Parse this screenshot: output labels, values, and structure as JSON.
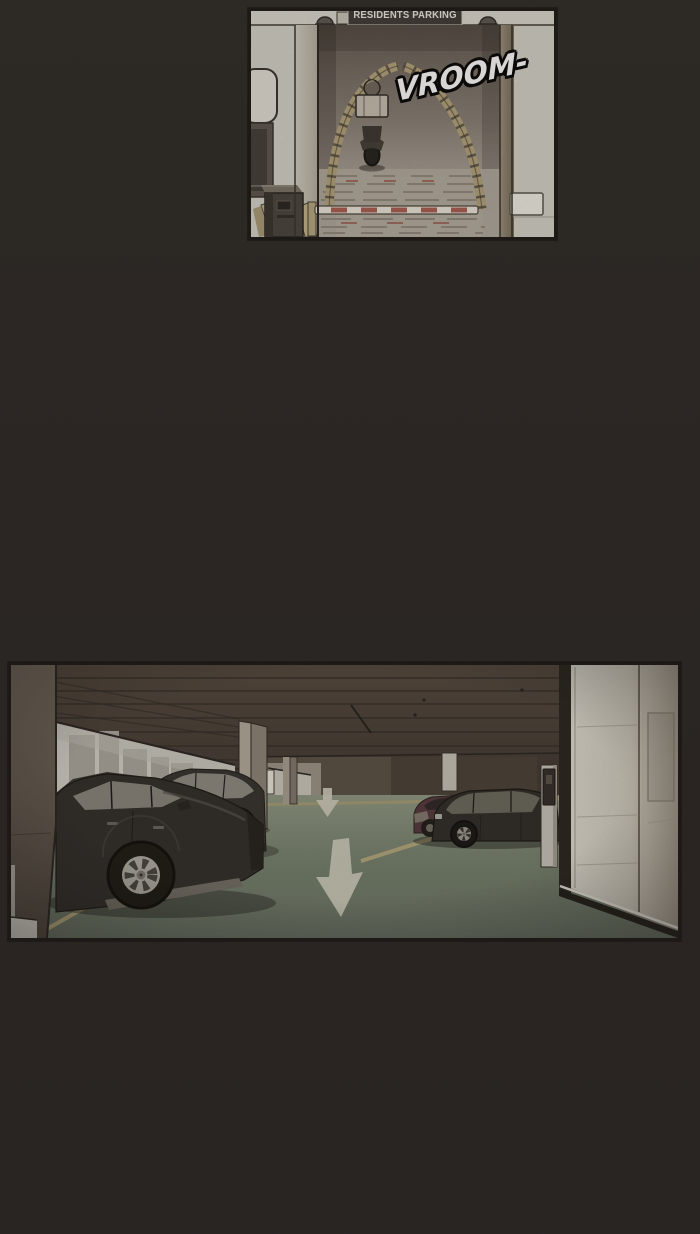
{
  "page": {
    "kind": "webtoon comic page",
    "background_color": "#2a2521"
  },
  "panels": {
    "top": {
      "name": "residents parking entrance ramp with scooter",
      "sign_label": "RESIDENTS PARKING",
      "sfx_label": "VROOM-",
      "colors": {
        "wall": "#d6d2c9",
        "ramp_shadow": "#5f554c",
        "ramp_edge_tan": "#b2a178",
        "barrier_white": "#ebe6db",
        "barrier_red": "#a34b40"
      }
    },
    "bottom": {
      "name": "underground parking garage with parked cars and elevator lobby",
      "colors": {
        "ceiling": "#493e34",
        "floor_green": "#75806c",
        "stall_line_tan": "#b7aa7c",
        "elevator_wall": "#d9d5ca",
        "car_black": "#2c2925",
        "car_maroon": "#523339",
        "floor_arrow": "#d0cdbc"
      }
    }
  }
}
